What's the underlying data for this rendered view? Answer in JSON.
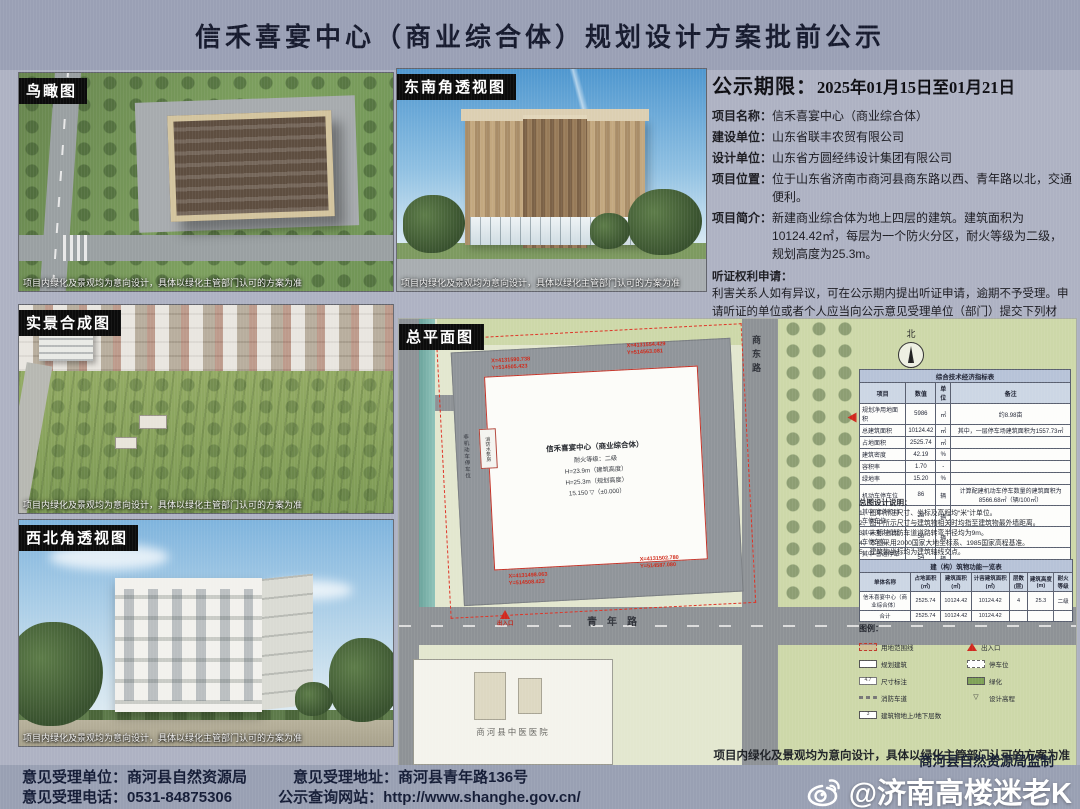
{
  "header": {
    "title": "信禾喜宴中心（商业综合体）规划设计方案批前公示"
  },
  "colors": {
    "poster_bg": "#aeb2c3",
    "band_bg": "#9aa0b5",
    "plan_bg": "#e3e7cf",
    "road_gray": "#8e9296",
    "lawn_green": "#cdd8a9",
    "red_line": "#df3224",
    "table_header_blue": "#b7c3d8",
    "watermark_white": "#ffffff"
  },
  "panels": {
    "birdseye": {
      "label": "鸟瞰图",
      "caption": "项目内绿化及景观均为意向设计，具体以绿化主管部门认可的方案为准"
    },
    "southeast": {
      "label": "东南角透视图",
      "caption": "项目内绿化及景观均为意向设计，具体以绿化主管部门认可的方案为准"
    },
    "realscene": {
      "label": "实景合成图",
      "caption": "项目内绿化及景观均为意向设计，具体以绿化主管部门认可的方案为准"
    },
    "northwest": {
      "label": "西北角透视图",
      "caption": "项目内绿化及景观均为意向设计，具体以绿化主管部门认可的方案为准"
    },
    "siteplan": {
      "label": "总平面图",
      "caption": "项目内绿化及景观均为意向设计，具体以绿化主管部门认可的方案为准"
    }
  },
  "notice": {
    "period_label": "公示期限：",
    "period_value": "2025年01月15日至01月21日",
    "fields": [
      {
        "label": "项目名称：",
        "value": "信禾喜宴中心（商业综合体）"
      },
      {
        "label": "建设单位：",
        "value": "山东省联丰农贸有限公司"
      },
      {
        "label": "设计单位：",
        "value": "山东省方圆经纬设计集团有限公司"
      },
      {
        "label": "项目位置：",
        "value": "位于山东省济南市商河县商东路以西、青年路以北，交通便利。"
      },
      {
        "label": "项目简介：",
        "value": "新建商业综合体为地上四层的建筑。建筑面积为10124.42㎡，每层为一个防火分区，耐火等级为二级，规划高度为25.3m。"
      }
    ],
    "hearing_title": "听证权利申请：",
    "hearing_lines": [
      "利害关系人如有异议，可在公示期内提出听证申请，逾期不予受理。申请听证的单位或者个人应当向公示意见受理单位（部门）提交下列材料：",
      "（1）书面申请；",
      "（2）个人提交居民身份证、户口簿复印件（查验原件）；",
      "（3）与公示项目存在直接利害关系的证明材料：如房产证、土地证、购房合同等复印件（查验原件）。",
      "商河县自然资源局对听证及相关材料进行审查后，做出是否听证的决定，并书面告知听证申请人。"
    ]
  },
  "siteplan": {
    "north_label": "北",
    "road_south": "青年路",
    "road_east": "商东路",
    "hospital": "商河县中医医院",
    "entrance_label": "出入口",
    "building": {
      "name": "信禾喜宴中心（商业综合体）",
      "fire": "耐火等级：二级",
      "h1": "H=23.9m（建筑高度）",
      "h2": "H=25.3m（规划高度）",
      "elev_top": "15.150",
      "elev_zero": "▽（±0.000）",
      "annex": "消防水泵房",
      "bike": "非机动车停车位"
    },
    "coords": [
      {
        "x": "X=4131590.738",
        "y": "Y=514505.423"
      },
      {
        "x": "X=4131554.429",
        "y": "Y=514563.081"
      },
      {
        "x": "X=4131498.063",
        "y": "Y=514508.423"
      },
      {
        "x": "X=4131502.780",
        "y": "Y=514587.080"
      }
    ],
    "indicator_table": {
      "title": "综合技术经济指标表",
      "headers": [
        "项目",
        "数值",
        "单位",
        "备注"
      ],
      "rows": [
        [
          "规划净用地面积",
          "5986",
          "㎡",
          "约8.98亩"
        ],
        [
          "总建筑面积",
          "10124.42",
          "㎡",
          "其中，一层停车场建筑面积为1557.73㎡"
        ],
        [
          "占地面积",
          "2525.74",
          "㎡",
          ""
        ],
        [
          "建筑密度",
          "42.19",
          "%",
          ""
        ],
        [
          "容积率",
          "1.70",
          "-",
          ""
        ],
        [
          "绿地率",
          "15.20",
          "%",
          ""
        ],
        [
          "机动车停车位",
          "86",
          "辆",
          "计算配建机动车停车数量的建筑面积为8566.68㎡（辆/100㎡）"
        ],
        [
          "其中 室外机动车停车位",
          "28",
          "辆",
          ""
        ],
        [
          "其中 室内机动车停车位",
          "58",
          "辆",
          ""
        ],
        [
          "其中 普通停车位",
          "54",
          "辆",
          ""
        ],
        [
          "其中 微型停车位",
          "4",
          "辆",
          "微型车6×0.7=4.2辆"
        ],
        [
          "非机动车停车位",
          "90",
          "辆",
          ""
        ]
      ]
    },
    "notes_title": "总图设计说明：",
    "notes": [
      "1、图中所注尺寸、坐标及高程均“米”计单位。",
      "2、图中所示尺寸与建筑物相关时均指至建筑物最外墙距离。",
      "3、未标注消防车道道路转弯半径均为9m。",
      "4、本图采用2000国家大地坐标系、1985国家高程基准。",
      "5、建筑物坐标均为建筑轴线交点。"
    ],
    "function_table": {
      "title": "建（构）筑物功能一览表",
      "headers": [
        "单体名称",
        "占地面积(㎡)",
        "建筑面积(㎡)",
        "计容建筑面积(㎡)",
        "层数(层)",
        "建筑高度(m)",
        "耐火等级"
      ],
      "rows": [
        [
          "信禾喜宴中心（商业综合体）",
          "2525.74",
          "10124.42",
          "10124.42",
          "4",
          "25.3",
          "二级"
        ],
        [
          "合计",
          "2525.74",
          "10124.42",
          "10124.42",
          "",
          "",
          ""
        ]
      ]
    },
    "legend": {
      "title": "图例：",
      "items": [
        {
          "label": "用地范围线",
          "mark": ""
        },
        {
          "label": "规划建筑",
          "mark": ""
        },
        {
          "label": "尺寸标注",
          "mark": "4.7"
        },
        {
          "label": "消防车道",
          "mark": ""
        },
        {
          "label": "建筑物地上/地下层数",
          "mark": "3"
        },
        {
          "label": "出入口",
          "mark": ""
        },
        {
          "label": "停车位",
          "mark": ""
        },
        {
          "label": "绿化",
          "mark": ""
        },
        {
          "label": "设计高程",
          "mark": "▽"
        }
      ]
    }
  },
  "footer": {
    "line1_left": "意见受理单位：商河县自然资源局",
    "line1_right": "意见受理地址：商河县青年路136号",
    "line2_left": "意见受理电话：0531-84875306",
    "line2_right": "公示查询网站：http://www.shanghe.gov.cn/",
    "supervisor": "商河县自然资源局监制",
    "watermark": "@济南高楼迷老K"
  }
}
